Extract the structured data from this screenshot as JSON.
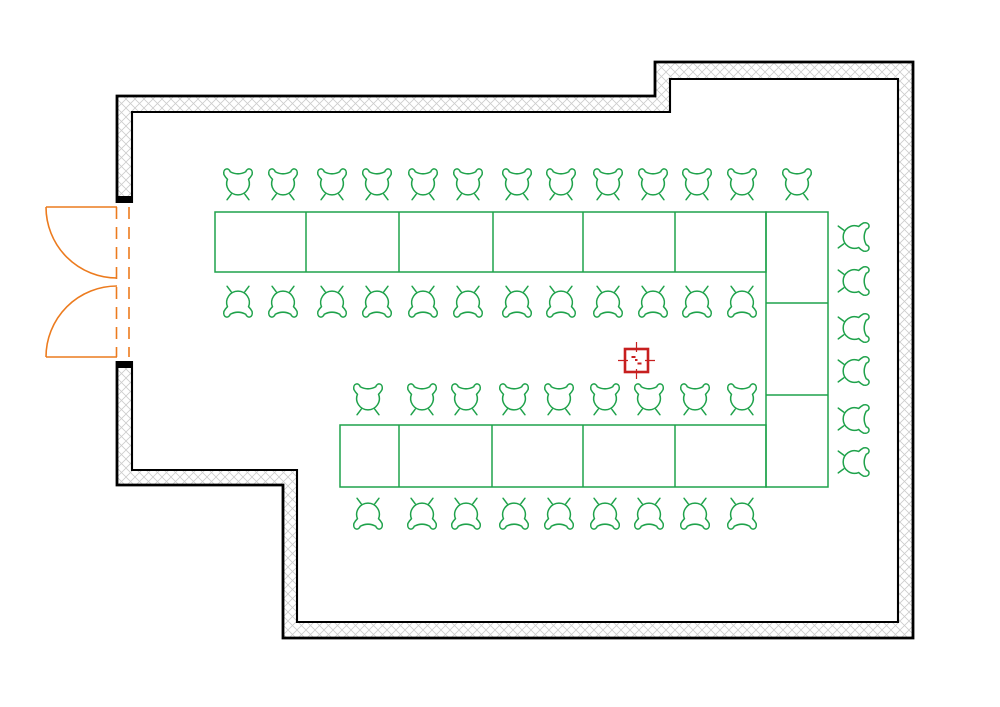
{
  "canvas": {
    "width": 1000,
    "height": 707,
    "background": "#ffffff"
  },
  "colors": {
    "wall_line": "#000000",
    "wall_hatch": "#cccccc",
    "furniture_green": "#1fa24b",
    "door_orange": "#ec7b1e",
    "marker_red": "#c71f1f",
    "floor": "#ffffff"
  },
  "icons": {
    "chair": "chair-icon",
    "door": "double-swing-door-icon",
    "marker": "position-marker-icon"
  },
  "walls": {
    "outer_polygon": [
      [
        117,
        96
      ],
      [
        655,
        96
      ],
      [
        655,
        62
      ],
      [
        913,
        62
      ],
      [
        913,
        638
      ],
      [
        283,
        638
      ],
      [
        283,
        485
      ],
      [
        117,
        485
      ]
    ],
    "inner_polygon": [
      [
        132,
        112
      ],
      [
        670,
        112
      ],
      [
        670,
        79
      ],
      [
        898,
        79
      ],
      [
        898,
        622
      ],
      [
        297,
        622
      ],
      [
        297,
        470
      ],
      [
        132,
        470
      ]
    ],
    "thickness": 15
  },
  "door": {
    "opening_rect": {
      "x": 113,
      "y": 203,
      "w": 23,
      "h": 158
    },
    "caps": [
      {
        "x": 116,
        "y": 196,
        "w": 17,
        "h": 7
      },
      {
        "x": 116,
        "y": 361,
        "w": 17,
        "h": 7
      }
    ],
    "leaves": [
      {
        "hinge": [
          117,
          207
        ],
        "tip": [
          46,
          207
        ],
        "arc_end": [
          117,
          278
        ],
        "radius": 71,
        "sweep": 0
      },
      {
        "hinge": [
          117,
          357
        ],
        "tip": [
          46,
          357
        ],
        "arc_end": [
          117,
          286
        ],
        "radius": 71,
        "sweep": 1
      }
    ],
    "closed_dashed_lines": [
      {
        "x": 116.5,
        "y1": 207,
        "y2": 357
      },
      {
        "x": 129,
        "y1": 207,
        "y2": 357
      }
    ]
  },
  "tables": [
    {
      "name": "table-row-top",
      "x": 215,
      "y": 212,
      "w": 551,
      "h": 60,
      "dividers_x": [
        306,
        399,
        493,
        583,
        675
      ],
      "dividers_y": []
    },
    {
      "name": "table-column-right",
      "x": 766,
      "y": 212,
      "w": 62,
      "h": 275,
      "dividers_x": [],
      "dividers_y": [
        303,
        395
      ]
    },
    {
      "name": "table-row-bottom",
      "x": 340,
      "y": 425,
      "w": 426,
      "h": 62,
      "dividers_x": [
        399,
        492,
        583,
        675
      ],
      "dividers_y": []
    }
  ],
  "chairs": {
    "scale": 0.88,
    "rows": [
      {
        "name": "chair-row-top-outer",
        "facing": "down",
        "y": 186,
        "xs": [
          238,
          283,
          332,
          377,
          423,
          468,
          517,
          561,
          608,
          653,
          697,
          742,
          797
        ]
      },
      {
        "name": "chair-row-top-inner",
        "facing": "up",
        "y": 300,
        "xs": [
          238,
          283,
          332,
          377,
          423,
          468,
          517,
          561,
          608,
          653,
          697,
          742
        ]
      },
      {
        "name": "chair-row-bottom-inner",
        "facing": "down",
        "y": 401,
        "xs": [
          368,
          422,
          466,
          514,
          559,
          605,
          649,
          695,
          742
        ]
      },
      {
        "name": "chair-row-bottom-outer",
        "facing": "up",
        "y": 512,
        "xs": [
          368,
          422,
          466,
          514,
          559,
          605,
          649,
          695,
          742
        ]
      },
      {
        "name": "chair-column-right",
        "facing": "left",
        "x": 852,
        "ys": [
          237,
          281,
          328,
          371,
          419,
          462
        ]
      }
    ]
  },
  "marker": {
    "cx": 636.5,
    "cy": 360.5,
    "half": 11.5,
    "tick": 7
  }
}
